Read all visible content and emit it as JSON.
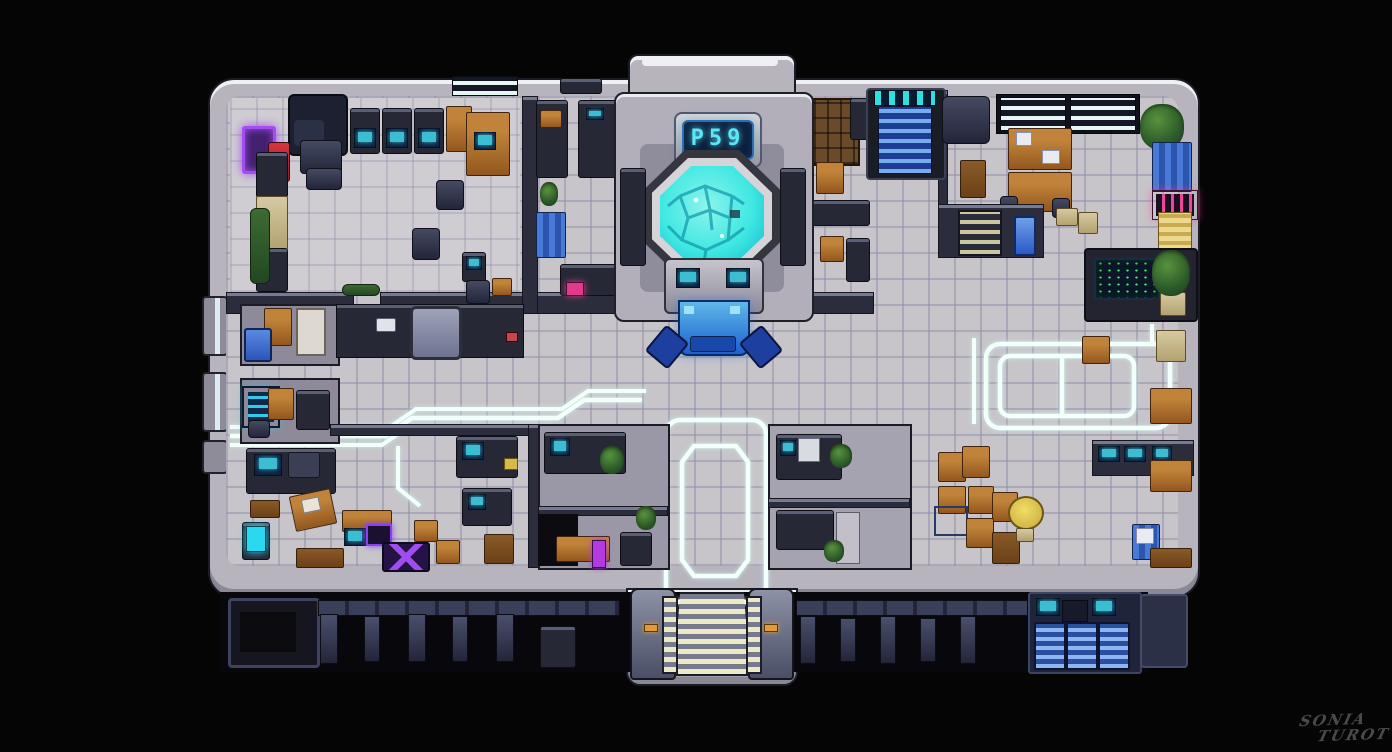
{
  "tower": {
    "display_text": "P59"
  },
  "signature": {
    "line1": "SONIA",
    "line2": "TUROT"
  },
  "palette": {
    "background": "#050506",
    "hull": "#b7b4bd",
    "hull_highlight": "#f4f6fa",
    "wall_top": "#767a92",
    "wall_body": "#2b2d3c",
    "floor_tile": "#c7c5c9",
    "floor_grout": "#9490aa",
    "glow_line": "#f2fffb",
    "pool_cyan": "#3fe8e2",
    "pool_deep": "#10b6cc",
    "screen_cyan": "#46d9ec",
    "display_cyan": "#5ae6f4",
    "neon_purple": "#a44df0",
    "neon_pink": "#f0459a",
    "stair_blue": "#2f63c8",
    "step_cream": "#ece9c6",
    "wood": "#a5682f",
    "vending_red": "#d6353f",
    "locker_yellow": "#e0c878",
    "crate_blue": "#3f6fd0"
  }
}
